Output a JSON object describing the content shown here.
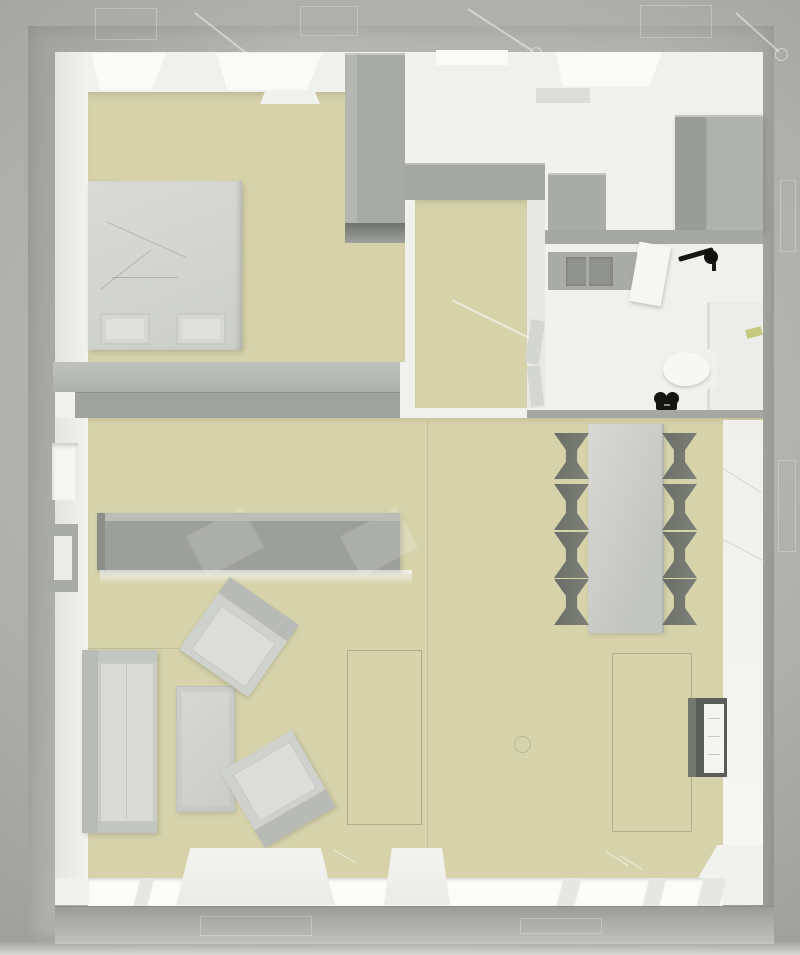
{
  "meta": {
    "title": "Top-down 3D architectural floor plan render",
    "view": "orthographic top view, roof removed",
    "visible_text": "none"
  },
  "colors": {
    "void_light": "#c0c0bc",
    "void_mid": "#adada9",
    "void_dark": "#8e8e8a",
    "wall_band": "#b2b2ae",
    "floor_white": "#f0f0ed",
    "floor_beige": "#d6d3ab",
    "furn_mid": "#a9aba7",
    "furn_dark": "#9d9f9b",
    "table_gray": "#c3c5c1",
    "chair_dark": "#6b6d67",
    "glass_white": "#fbfbf9",
    "green_accent": "#c6ca80",
    "black_accent": "#151513"
  },
  "rooms": [
    {
      "name": "bedroom",
      "floor": "beige",
      "furniture": [
        "double bed with two pillows",
        "tall wardrobe",
        "built-in closet band"
      ]
    },
    {
      "name": "entry-hall",
      "floor": "beige",
      "furniture": [
        "open door panels against right wall"
      ]
    },
    {
      "name": "kitchen",
      "floor": "white",
      "furniture": [
        "counter block",
        "tall cabinet fridge",
        "wall shelf"
      ]
    },
    {
      "name": "bathroom",
      "floor": "white",
      "furniture": [
        "sink vanity with basin",
        "open door",
        "black faucet fixture",
        "toilet",
        "black accessory",
        "shower with glass partition",
        "green plant accent"
      ]
    },
    {
      "name": "living-dining-room",
      "floor": "beige",
      "furniture": [
        "dining table",
        "eight dark chairs",
        "long sideboard",
        "sofa",
        "coffee table",
        "two rotated armchairs",
        "tv media unit",
        "two rug outlines",
        "window benches"
      ]
    }
  ],
  "openings": {
    "bottom_windows": 5,
    "top_window_glows": 4,
    "left_wall_niches": 2
  }
}
